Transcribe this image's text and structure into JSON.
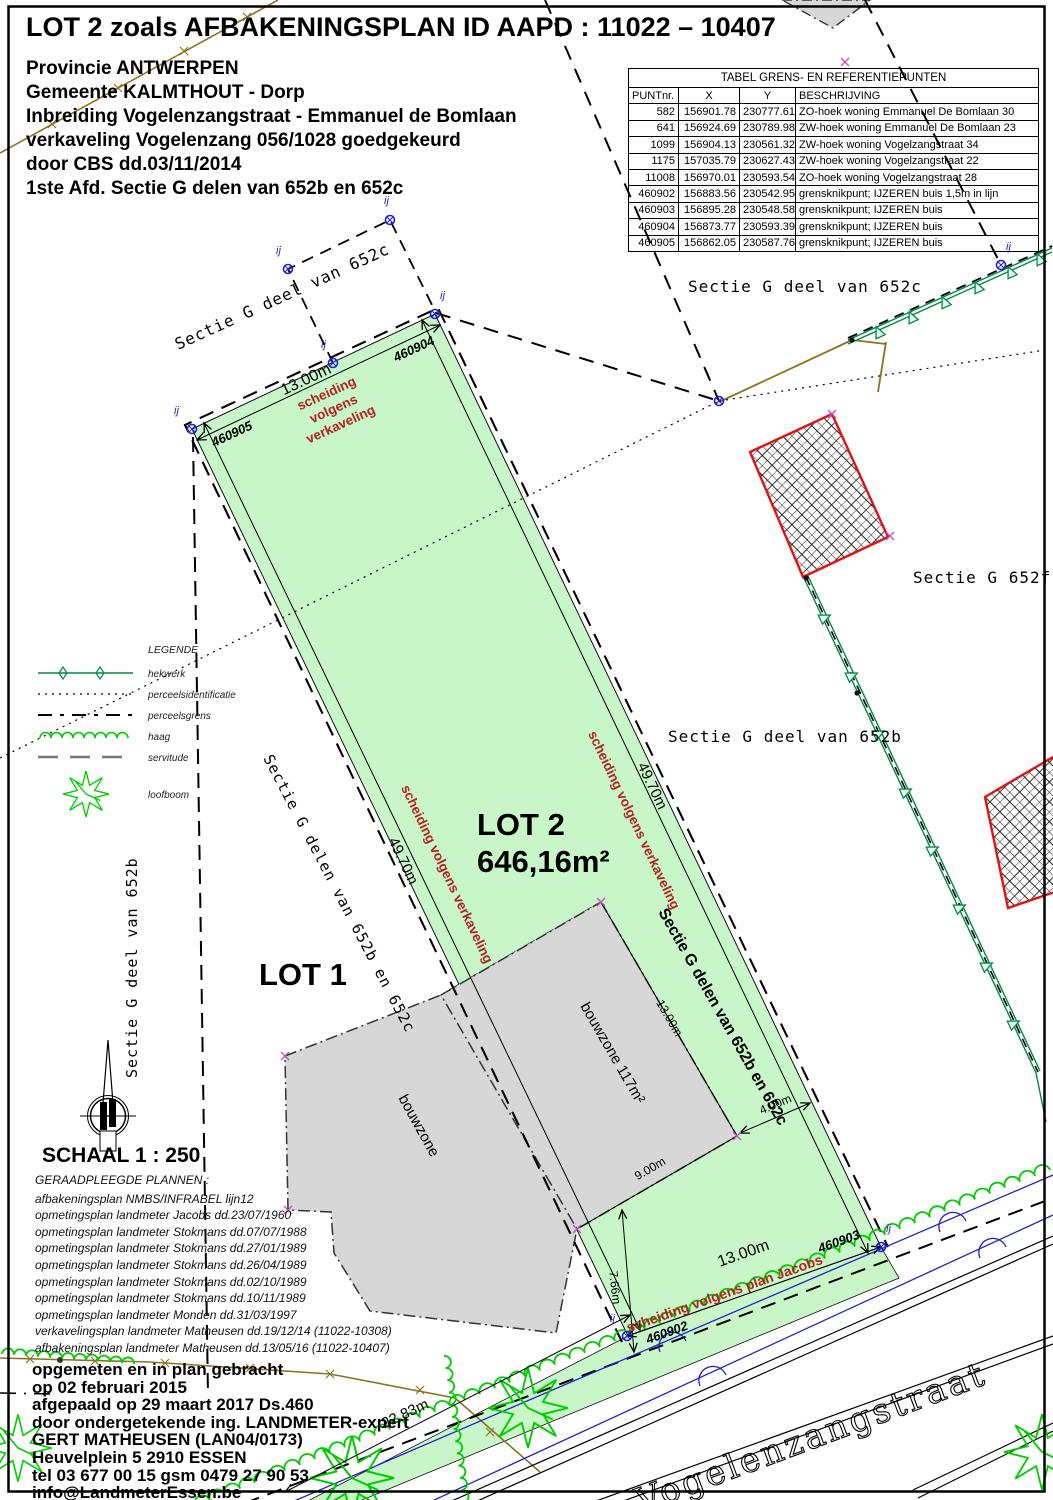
{
  "title_block": {
    "title": "LOT 2 zoals AFBAKENINGSPLAN ID AAPD : 11022 – 10407",
    "lines": [
      "Provincie ANTWERPEN",
      "Gemeente KALMTHOUT - Dorp",
      "Inbreiding Vogelenzangstraat - Emmanuel de Bomlaan",
      "verkaveling Vogelenzang 056/1028 goedgekeurd",
      "door CBS dd.03/11/2014",
      "1ste Afd. Sectie G delen van 652b en 652c"
    ]
  },
  "ref_table": {
    "title": "TABEL GRENS- EN REFERENTIEPUNTEN",
    "headers": [
      "PUNTnr.",
      "X",
      "Y",
      "BESCHRIJVING"
    ],
    "rows": [
      {
        "punt": "582",
        "x": "156901.78",
        "y": "230777.61",
        "desc": "ZO-hoek woning Emmanuel De Bomlaan 30"
      },
      {
        "punt": "641",
        "x": "156924.69",
        "y": "230789.98",
        "desc": "ZW-hoek woning Emmanuel De Bomlaan 23"
      },
      {
        "punt": "1099",
        "x": "156904.13",
        "y": "230561.32",
        "desc": "ZW-hoek woning Vogelzangstraat 34"
      },
      {
        "punt": "1175",
        "x": "157035.79",
        "y": "230627.43",
        "desc": "ZW-hoek woning Vogelzangstraat 22"
      },
      {
        "punt": "11008",
        "x": "156970.01",
        "y": "230593.54",
        "desc": "ZO-hoek woning Vogelzangstraat 28"
      },
      {
        "punt": "460902",
        "x": "156883.56",
        "y": "230542.95",
        "desc": "grensknikpunt; IJZEREN buis 1,5m in lijn"
      },
      {
        "punt": "460903",
        "x": "156895.28",
        "y": "230548.58",
        "desc": "grensknikpunt; IJZEREN buis"
      },
      {
        "punt": "460904",
        "x": "156873.77",
        "y": "230593.39",
        "desc": "grensknikpunt; IJZEREN buis"
      },
      {
        "punt": "460905",
        "x": "156862.05",
        "y": "230587.76",
        "desc": "grensknikpunt; IJZEREN buis"
      }
    ]
  },
  "legend": {
    "title": "LEGENDE",
    "items": [
      {
        "icon": "hekwerk-line-icon",
        "label": "hekwerk"
      },
      {
        "icon": "dotted-line-icon",
        "label": "perceelsidentificatie"
      },
      {
        "icon": "dashed-line-icon",
        "label": "perceelsgrens"
      },
      {
        "icon": "haag-wavy-line-icon",
        "label": "haag"
      },
      {
        "icon": "servitude-line-icon",
        "label": "servitude"
      },
      {
        "icon": "loofboom-tree-icon",
        "label": "loofboom"
      }
    ]
  },
  "scale_label": "SCHAAL 1 : 250",
  "consulted_plans": {
    "title": "GERAADPLEEGDE PLANNEN :",
    "lines": [
      "afbakeningsplan NMBS/INFRABEL  lijn12",
      "opmetingsplan landmeter Jacobs dd.23/07/1960",
      "opmetingsplan landmeter Stokmans dd.07/07/1988",
      "opmetingsplan landmeter Stokmans dd.27/01/1989",
      "opmetingsplan landmeter Stokmans dd.26/04/1989",
      "opmetingsplan landmeter Stokmans dd.02/10/1989",
      "opmetingsplan landmeter Stokmans dd.10/11/1989",
      "opmetingsplan landmeter Monden dd.31/03/1997",
      "verkavelingsplan landmeter Matheusen dd.19/12/14 (11022-10308)",
      "afbakeningsplan landmeter Matheusen dd.13/05/16 (11022-10407)"
    ]
  },
  "surveyor_block": {
    "lines": [
      "opgemeten en in plan gebracht",
      "op 02 februari 2015",
      "afgepaald op 29 maart 2017 Ds.460",
      "door ondergetekende ing. LANDMETER-expert",
      "GERT MATHEUSEN  (LAN04/0173)",
      "Heuvelplein 5   2910 ESSEN",
      "tel 03 677 00 15    gsm 0479 27 90 53",
      "info@LandmeterEssen.be"
    ]
  },
  "map": {
    "lot1_label": "LOT 1",
    "lot2_label": "LOT 2",
    "lot2_area": "646,16m²",
    "bouwzone_left": "bouwzone",
    "bouwzone_right": "bouwzone 117m²",
    "street_name": "Vogelenzangstraat",
    "sections": {
      "left_top": "Sectie G deel van 652c",
      "right_top": "Sectie G deel van 652c",
      "right_mid": "Sectie G 652f",
      "mid_right": "Sectie G deel van 652b",
      "left_vertical": "Sectie G deel van 652b",
      "lot1_diagonal": "Sectie G delen van 652b en 652c",
      "lot2_diagonal": "Sectie G delen van 652b en 652c"
    },
    "dimensions": {
      "top_width": "13.00m",
      "left_length": "49.70m",
      "right_length": "49.70m",
      "bottom_width": "13.00m",
      "bouwzone_depth": "13.00m",
      "bouwzone_width": "9.00m",
      "side_offset": "4.00m",
      "front_offset": "7.66m",
      "street_frontage": "22.83m"
    },
    "red_labels": {
      "top_lines": [
        "scheiding",
        "volgens",
        "verkaveling"
      ],
      "left": "scheiding volgens verkaveling",
      "right": "scheiding volgens verkaveling",
      "bottom": "scheiding volgens plan Jacobs"
    },
    "point_labels": {
      "p460905": "460905",
      "p460904": "460904",
      "p460903": "460903",
      "p460902": "460902"
    },
    "marker_label": "ij",
    "colors": {
      "parcel_green": "#c9f6c9",
      "zone_gray": "#d7d7d7",
      "red_text": "#b22222",
      "hatch_red": "#e01212",
      "fence_green": "#008a46",
      "haag_green": "#00cc00",
      "point_blue": "#2222cc",
      "olive": "#8a7420",
      "magenta": "#c34ec3"
    }
  }
}
